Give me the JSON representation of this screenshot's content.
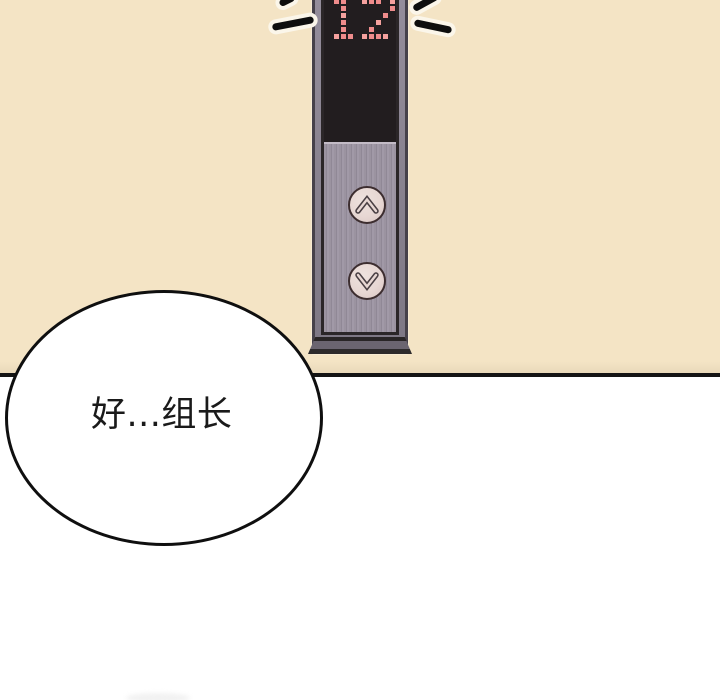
{
  "speech_bubble": {
    "text": "好...组长"
  },
  "elevator": {
    "floor_display": "12",
    "led_pattern_rows": [
      "XX..XXX.X",
      ".X......X",
      ".X.....X.",
      ".X....X..",
      ".X...X...",
      "XXX.XXXX."
    ],
    "up_button": {
      "icon": "chevron-up-icon"
    },
    "down_button": {
      "icon": "chevron-down-icon"
    }
  },
  "colors": {
    "background": "#f4e4c5",
    "lower_background": "#ffffff",
    "panel_border_line": "#141414",
    "bubble_fill": "#ffffff",
    "bubble_stroke": "#0f0f0f",
    "text": "#1a1a1a",
    "frame_outer": "#46414a",
    "frame_light": "#948d9b",
    "bezel_dark": "#2b2628",
    "screen_bg": "#221d1f",
    "led_dot": "#ef8c8c",
    "led_dot_bright": "#f5a19e",
    "metal_base": "#9b93a0",
    "metal_dark": "#908896",
    "metal_light": "#a199a7",
    "metal_highlight": "#c3bbc6",
    "button_fill": "#e7d7d3",
    "button_ring": "#3c2d2f",
    "chevron": "#4a4044",
    "emphasis_stroke": "#0e0e0e",
    "emphasis_halo": "#fbf6ea",
    "bevel_face": "#6b6570",
    "bevel_edge": "#292526"
  }
}
